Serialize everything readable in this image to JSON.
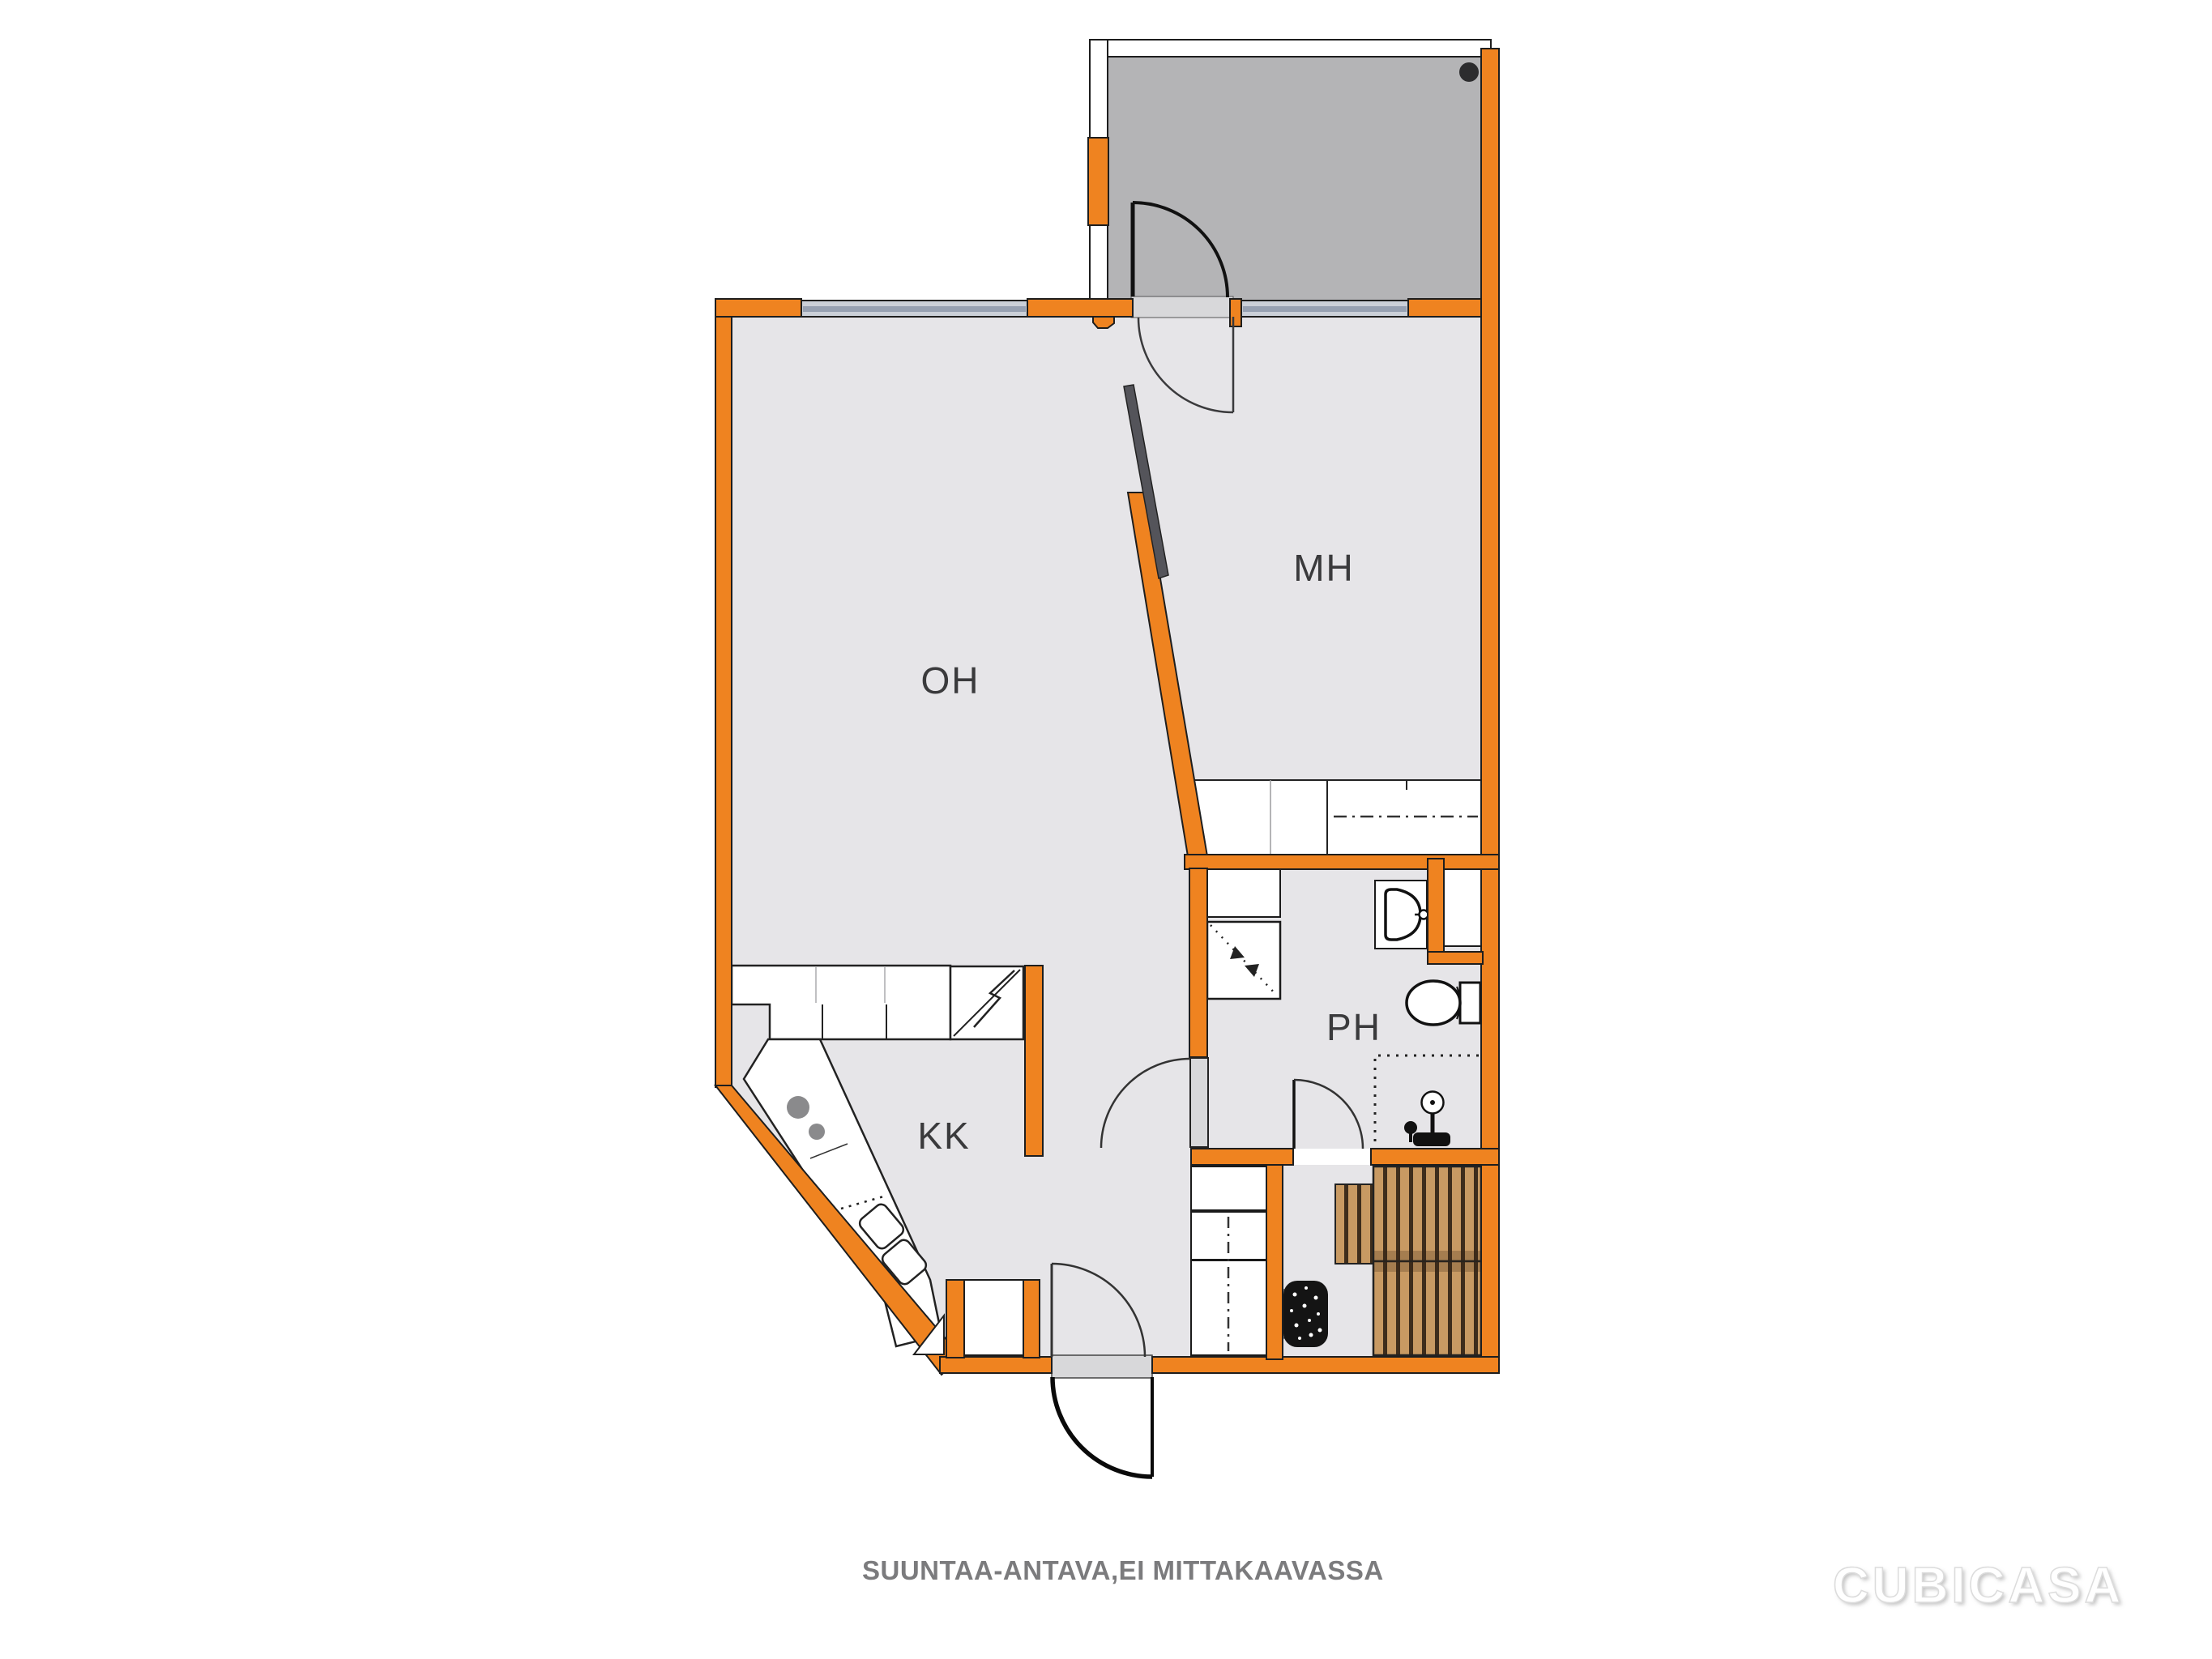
{
  "document": {
    "kind": "floor-plan",
    "style": "CubiCasa 2D"
  },
  "rooms": {
    "oh": {
      "label": "OH",
      "meaning": "living room"
    },
    "mh": {
      "label": "MH",
      "meaning": "bedroom"
    },
    "kk": {
      "label": "KK",
      "meaning": "kitchenette"
    },
    "ph": {
      "label": "PH",
      "meaning": "washroom"
    }
  },
  "footer": {
    "disclaimer": "SUUNTAA-ANTAVA,EI MITTAKAAVASSA"
  },
  "watermark": {
    "text": "CUBICASA"
  },
  "colors": {
    "wall_orange": "#EF8320",
    "outline": "#1E1E1E",
    "floor_gray": "#E6E5E8",
    "balcony_floor": "#B4B4B6",
    "threshold_gray": "#D8D8DA",
    "window_band": "#CBD0D8",
    "window_core": "#97A1B2",
    "wood_bench": "#C89A63",
    "wood_gap": "#3E2D1C",
    "sliding_door": "#54545A",
    "label_text": "#3A3A3C",
    "footer_text": "#7B7B7D"
  }
}
